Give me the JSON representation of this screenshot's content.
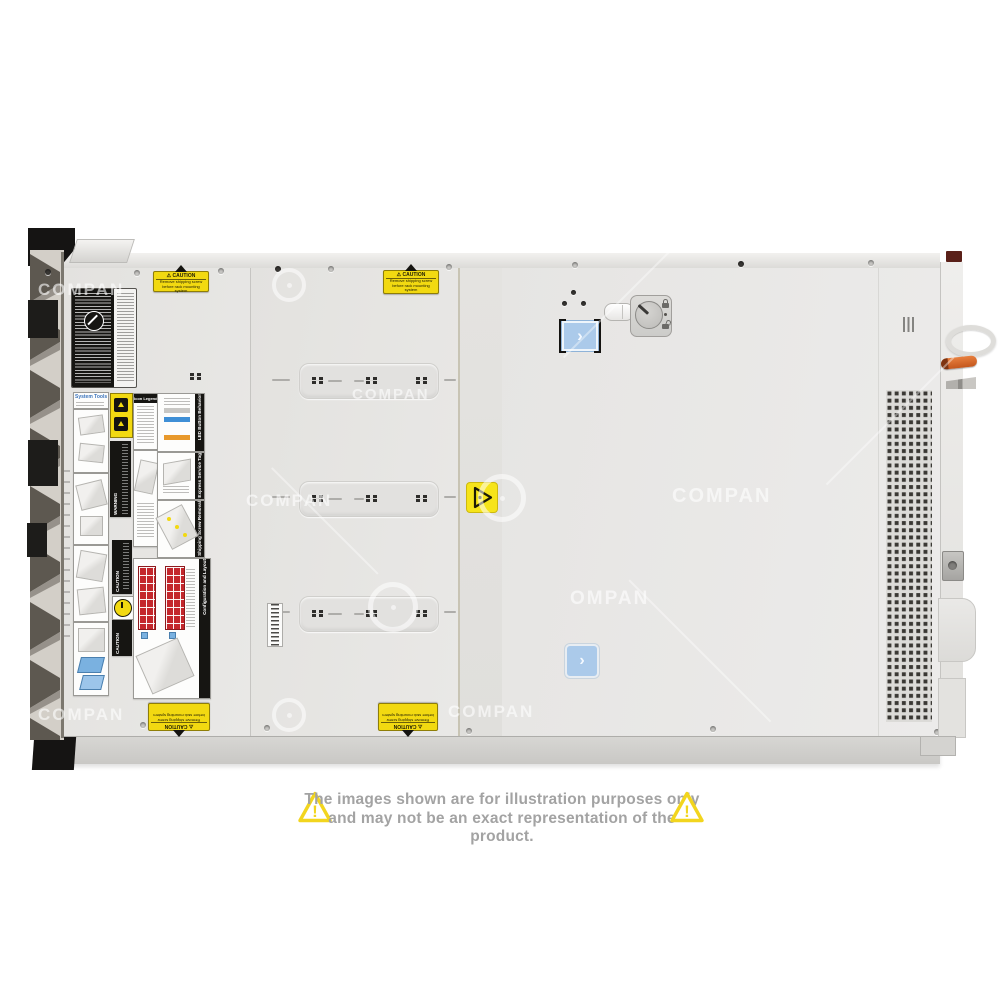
{
  "image": {
    "type": "product-photo",
    "subject": "rack-server-top-view"
  },
  "watermark": {
    "text": "COMPAN",
    "partial_text": "OMPAN"
  },
  "icons": {
    "warning_triangle": "⚠",
    "chevron_right": "›",
    "exclamation": "!"
  },
  "stickers": {
    "caution": {
      "title": "CAUTION",
      "line1": "Remove shipping screw",
      "line2": "before rack mounting system"
    }
  },
  "service_labels": {
    "system_tools": "System Tools",
    "icon_legend": "Icon Legend",
    "led_button_behavior": "LED Button Behavior",
    "rear_express_service_tag": "Rear Express Service Tag",
    "shipping_screw_removal": "Shipping Screw Removal",
    "warning": "WARNING",
    "caution": "CAUTION",
    "configuration_and_layout": "Configuration and Layout"
  },
  "disclaimer": {
    "line1": "The images shown are for illustration purposes only",
    "line2": "and may not be an exact representation of the product."
  },
  "colors": {
    "caution_yellow": "#f2d911",
    "accent_blue": "#abcaea",
    "drive_red": "#c4272c",
    "latch_orange": "#d96a2d",
    "disclaimer_text": "#a3a3a3",
    "triangle_yellow": "#f2d51e"
  }
}
